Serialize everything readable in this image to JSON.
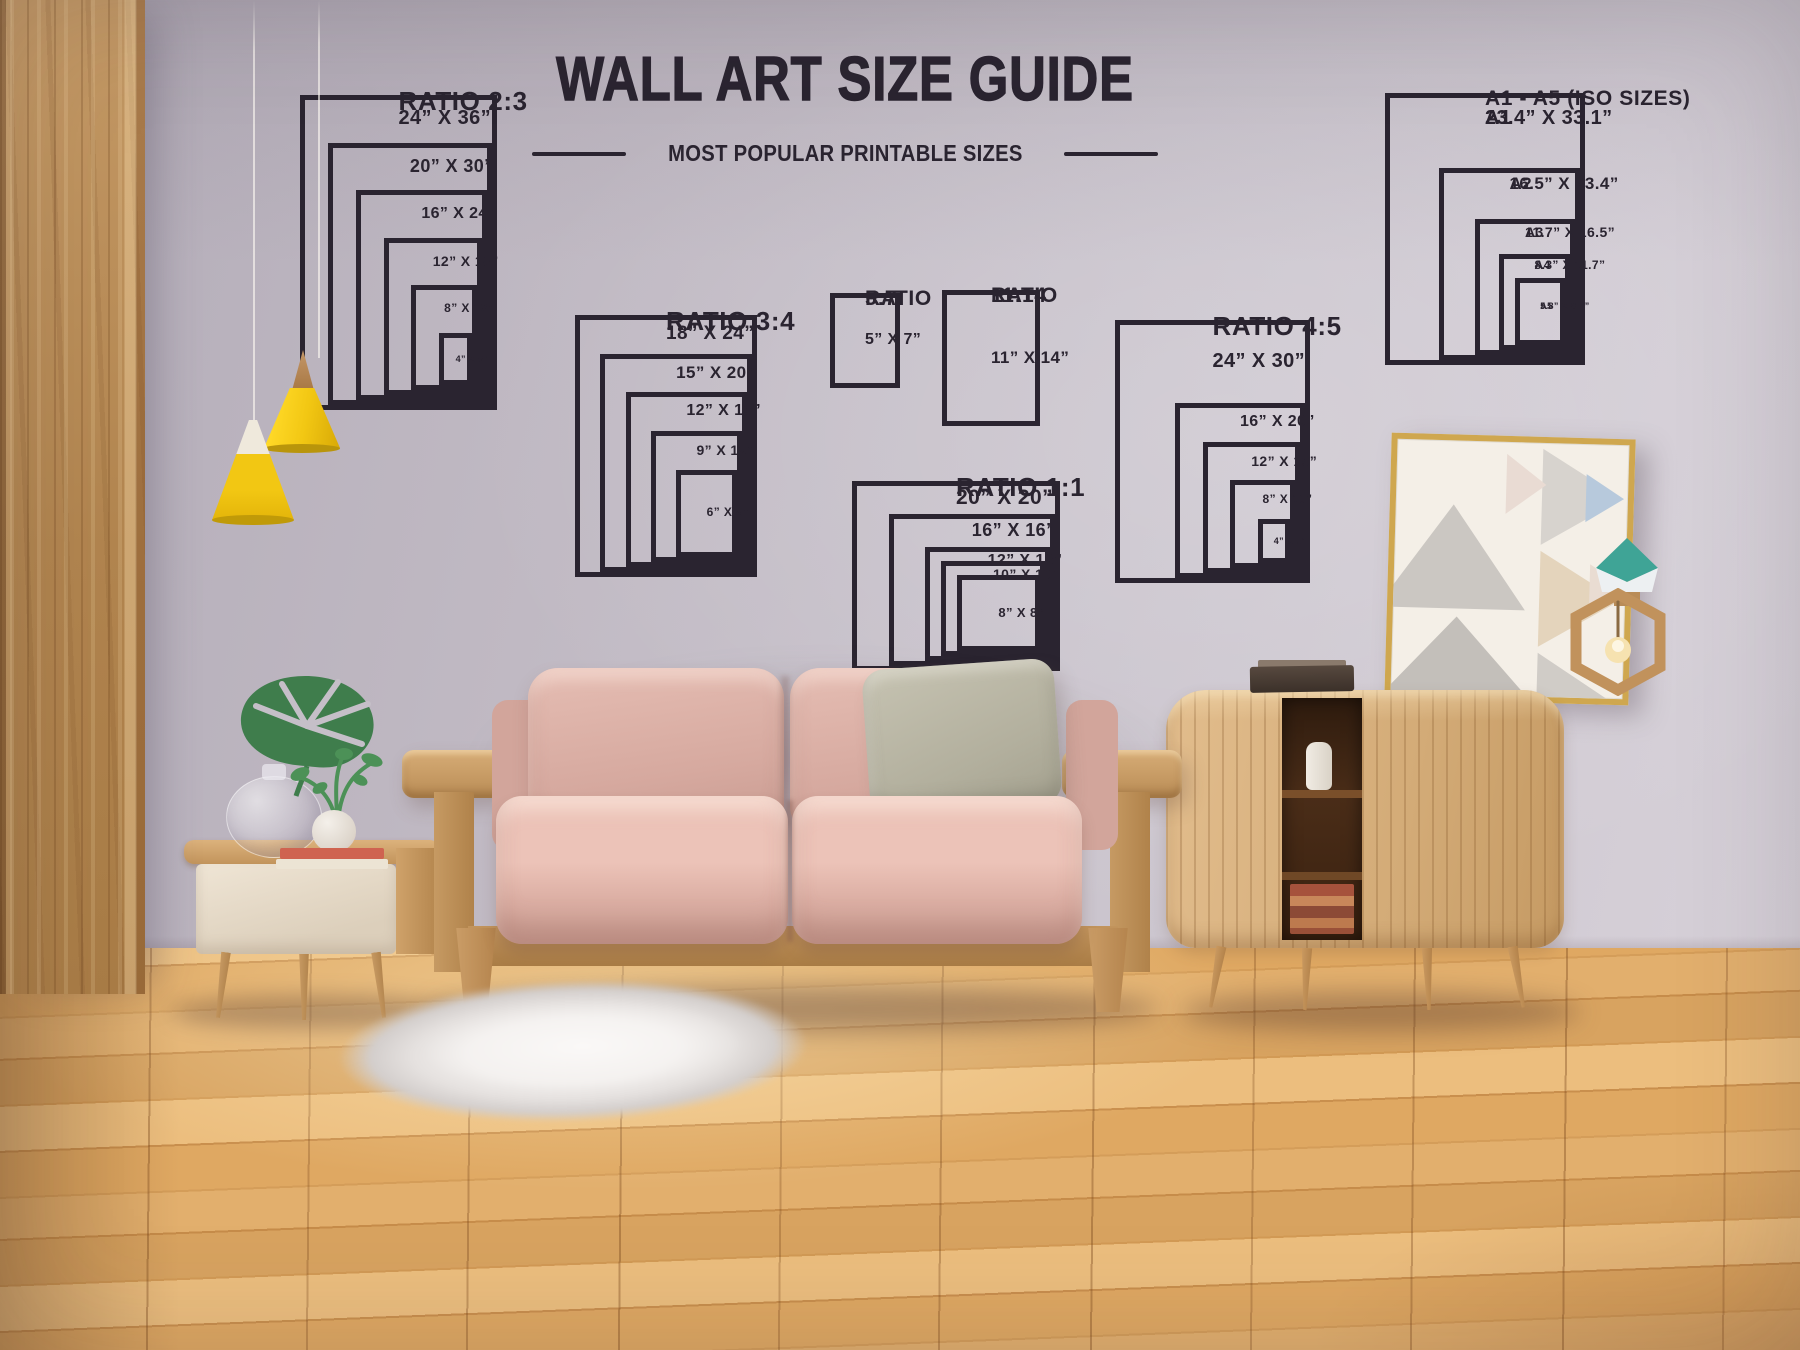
{
  "header": {
    "title": "WALL ART SIZE GUIDE",
    "subtitle": "MOST POPULAR PRINTABLE SIZES"
  },
  "diagrams": [
    {
      "id": "ratio-2-3",
      "title": "RATIO 2:3",
      "title_lines": [
        "RATIO 2:3"
      ],
      "sizes": [
        {
          "label": "24” X 36”",
          "w": 24,
          "h": 36
        },
        {
          "label": "20” X 30”",
          "w": 20,
          "h": 30
        },
        {
          "label": "16” X 24”",
          "w": 16,
          "h": 24
        },
        {
          "label": "12” X 18”",
          "w": 12,
          "h": 18
        },
        {
          "label": "8” X 12”",
          "w": 8,
          "h": 12
        },
        {
          "label": "4” X 6”",
          "w": 4,
          "h": 6
        }
      ]
    },
    {
      "id": "ratio-3-4",
      "title": "RATIO 3:4",
      "title_lines": [
        "RATIO 3:4"
      ],
      "sizes": [
        {
          "label": "18” X 24”",
          "w": 18,
          "h": 24
        },
        {
          "label": "15” X 20”",
          "w": 15,
          "h": 20
        },
        {
          "label": "12” X 16”",
          "w": 12,
          "h": 16
        },
        {
          "label": "9” X 12”",
          "w": 9,
          "h": 12
        },
        {
          "label": "6” X 8”",
          "w": 6,
          "h": 8
        }
      ]
    },
    {
      "id": "ratio-5-7",
      "title": "RATIO 5:7",
      "title_lines": [
        "RATIO",
        "5:7"
      ],
      "sizes": [
        {
          "label": "5” X 7”",
          "w": 5,
          "h": 7
        }
      ]
    },
    {
      "id": "ratio-11-14",
      "title": "RATIO 11:14",
      "title_lines": [
        "RATIO",
        "11:14"
      ],
      "sizes": [
        {
          "label": "11” X 14”",
          "w": 11,
          "h": 14
        }
      ]
    },
    {
      "id": "ratio-1-1",
      "title": "RATIO 1:1",
      "title_lines": [
        "RATIO 1:1"
      ],
      "sizes": [
        {
          "label": "20” X 20”",
          "w": 20,
          "h": 20
        },
        {
          "label": "16” X 16”",
          "w": 16,
          "h": 16
        },
        {
          "label": "12” X 12”",
          "w": 12,
          "h": 12
        },
        {
          "label": "10” X 10”",
          "w": 10,
          "h": 10
        },
        {
          "label": "8” X 8”",
          "w": 8,
          "h": 8
        }
      ]
    },
    {
      "id": "ratio-4-5",
      "title": "RATIO 4:5",
      "title_lines": [
        "RATIO 4:5"
      ],
      "sizes": [
        {
          "label": "24” X 30”",
          "w": 24,
          "h": 30
        },
        {
          "label": "16” X 20”",
          "w": 16,
          "h": 20
        },
        {
          "label": "12” X 15”",
          "w": 12,
          "h": 15
        },
        {
          "label": "8” X 10”",
          "w": 8,
          "h": 10
        },
        {
          "label": "4” X 5”",
          "w": 4,
          "h": 5
        }
      ]
    },
    {
      "id": "iso",
      "title": "A1 - A5 (ISO SIZES)",
      "title_lines": [
        "A1 - A5 (ISO SIZES)"
      ],
      "sizes": [
        {
          "name": "A1",
          "label": "23.4” X 33.1”",
          "w": 23.4,
          "h": 33.1
        },
        {
          "name": "A2",
          "label": "16.5” X 23.4”",
          "w": 16.5,
          "h": 23.4
        },
        {
          "name": "A3",
          "label": "11.7” X 16.5”",
          "w": 11.7,
          "h": 16.5
        },
        {
          "name": "A4",
          "label": "8.3” X 11.7”",
          "w": 8.3,
          "h": 11.7
        },
        {
          "name": "A5",
          "label": "5.8” X 8.2”",
          "w": 5.8,
          "h": 8.2
        }
      ]
    }
  ],
  "palette": {
    "ink": "#2a2430",
    "wall": "#c5bfc8",
    "wood": "#b98a55",
    "floor": "#dca765",
    "lamp_yellow": "#f2c713",
    "sofa_pink": "#d6a99f",
    "pillow_sage": "#b2af9d",
    "table_front_cream": "#efe5d5",
    "cabinet_wood": "#d3ab77",
    "frame_gold": "#cfa74f",
    "poster_cream": "#f4efe7",
    "teal": "#3fa496",
    "plant_green": "#3f7d4c",
    "rug_white": "#f2efed"
  }
}
